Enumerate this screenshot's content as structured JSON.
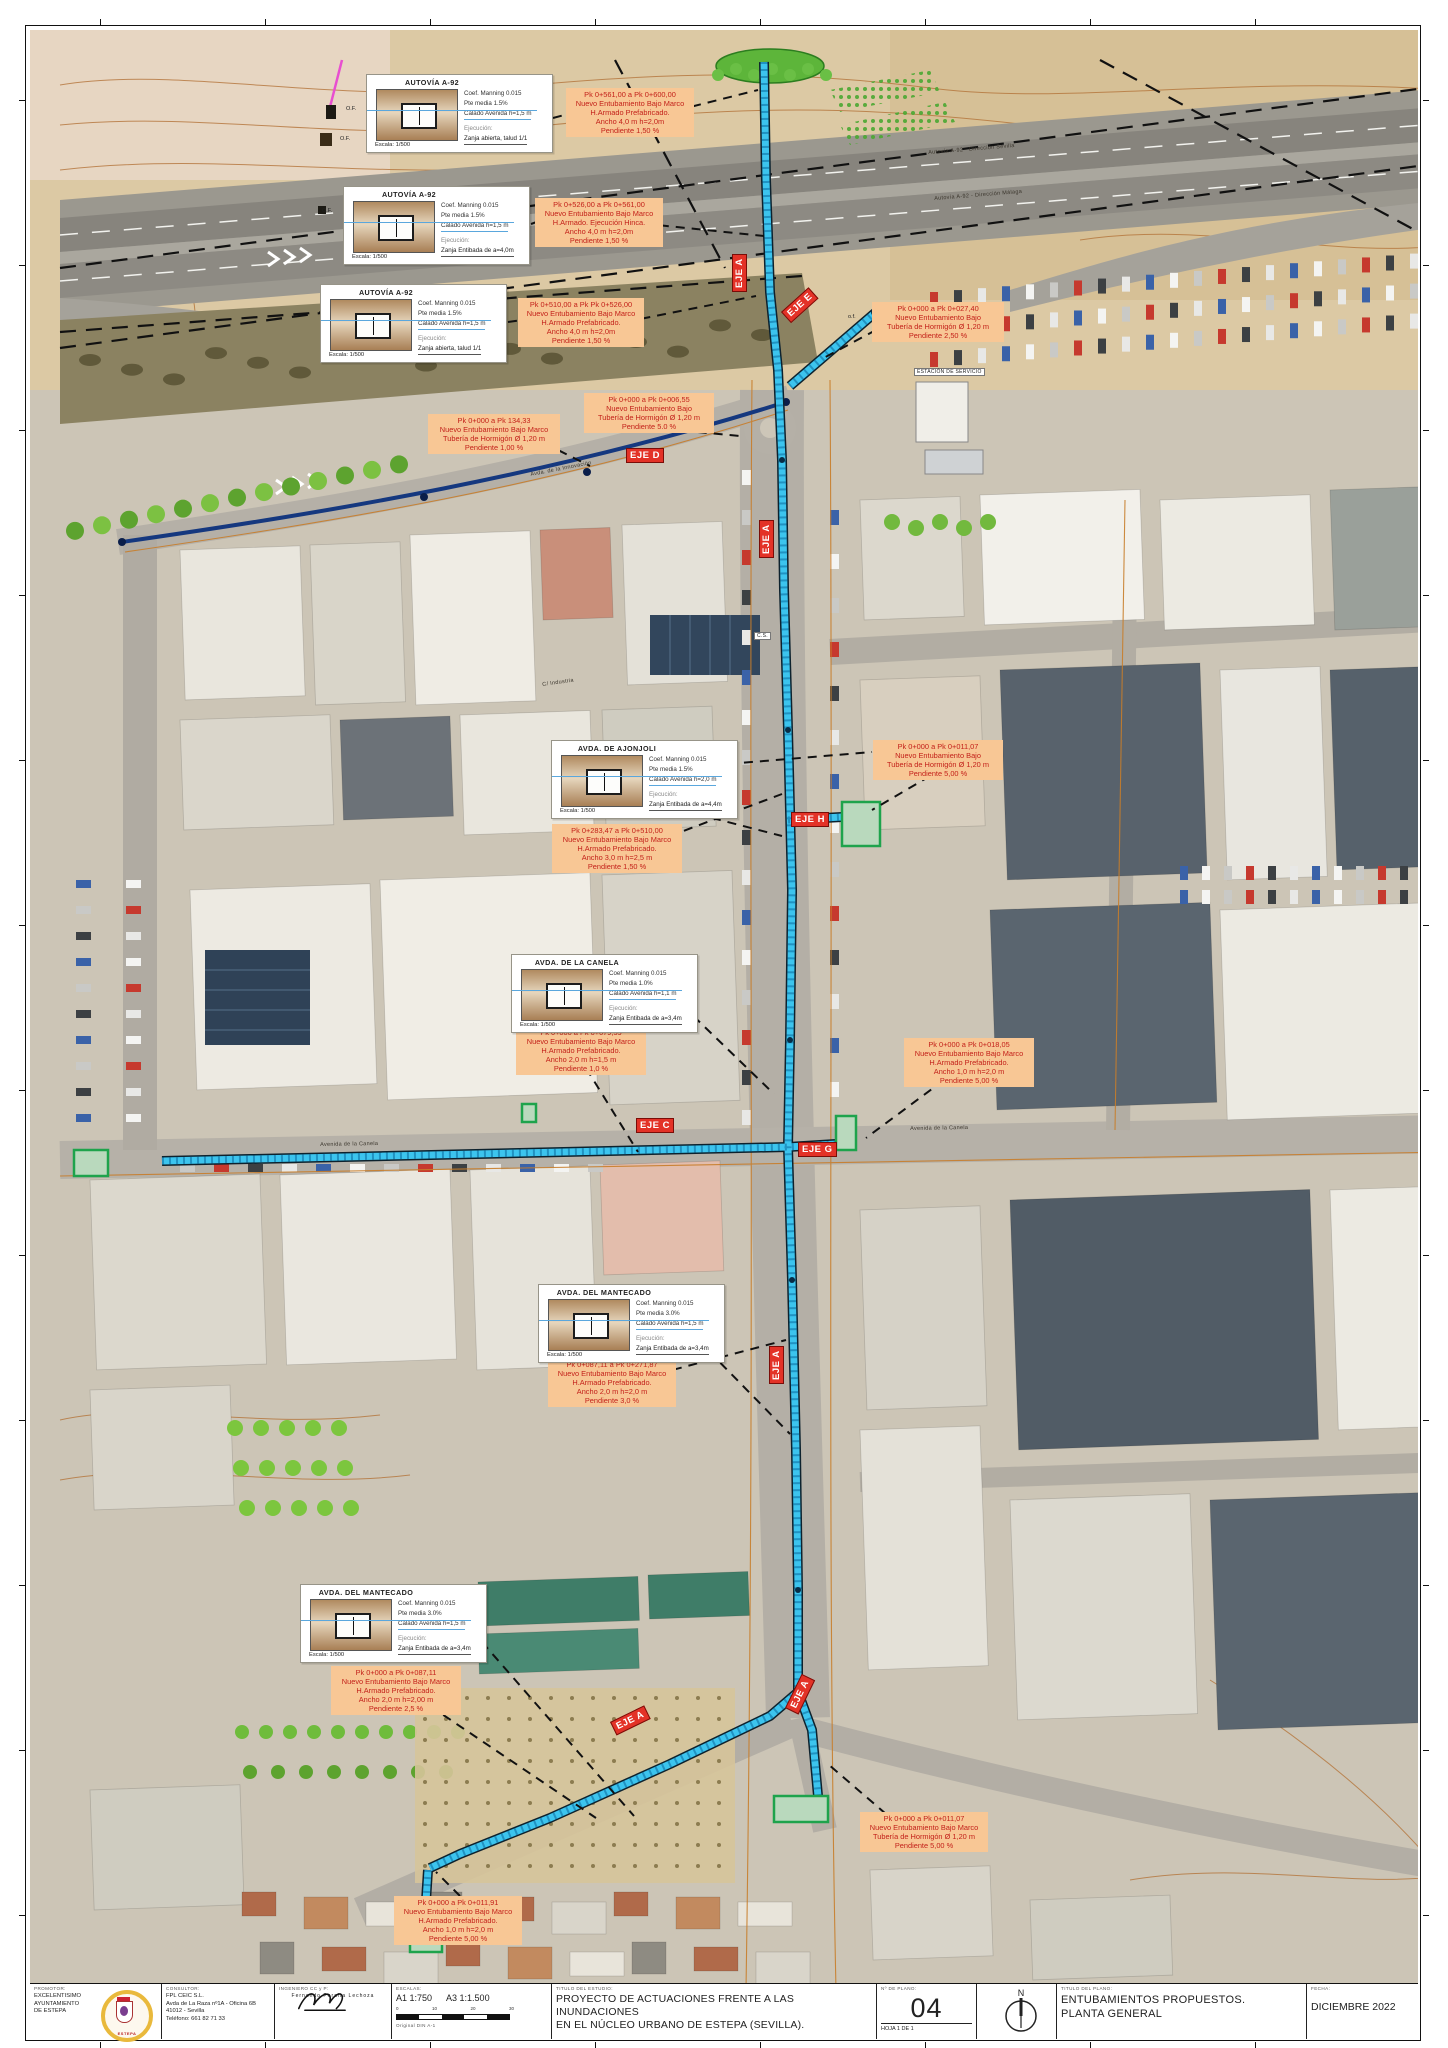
{
  "map": {
    "axis_labels": [
      {
        "label": "EJE A",
        "x": 702,
        "y": 262,
        "rot": -90
      },
      {
        "label": "EJE E",
        "x": 751,
        "y": 282,
        "rot": -42
      },
      {
        "label": "EJE D",
        "x": 596,
        "y": 418,
        "rot": 0
      },
      {
        "label": "EJE A",
        "x": 729,
        "y": 528,
        "rot": -90
      },
      {
        "label": "EJE H",
        "x": 761,
        "y": 782,
        "rot": 0
      },
      {
        "label": "EJE C",
        "x": 606,
        "y": 1088,
        "rot": 0
      },
      {
        "label": "EJE G",
        "x": 768,
        "y": 1112,
        "rot": 0
      },
      {
        "label": "EJE A",
        "x": 739,
        "y": 1354,
        "rot": -90
      },
      {
        "label": "EJE A",
        "x": 580,
        "y": 1692,
        "rot": -26
      },
      {
        "label": "EJE A",
        "x": 755,
        "y": 1678,
        "rot": -64
      }
    ],
    "detail_boxes": [
      {
        "x": 336,
        "y": 44,
        "title": "AUTOVÍA A-92",
        "coef": "Coef. Manning 0.015",
        "pte": "Pte media 1.5%",
        "calado": "Calado Avenida h=1,5 m",
        "ejec_label": "Ejecución:",
        "ejec": "Zanja abierta, talud 1/1",
        "escala": "Escala: 1/500"
      },
      {
        "x": 313,
        "y": 156,
        "title": "AUTOVÍA A-92",
        "coef": "Coef. Manning 0.015",
        "pte": "Pte media 1.5%",
        "calado": "Calado Avenida h=1,5 m",
        "ejec_label": "Ejecución:",
        "ejec": "Zanja Entibada de a=4,0m",
        "escala": "Escala: 1/500"
      },
      {
        "x": 290,
        "y": 254,
        "title": "AUTOVÍA A-92",
        "coef": "Coef. Manning 0.015",
        "pte": "Pte media 1.5%",
        "calado": "Calado Avenida h=1,5 m",
        "ejec_label": "Ejecución:",
        "ejec": "Zanja abierta, talud 1/1",
        "escala": "Escala: 1/500"
      },
      {
        "x": 521,
        "y": 710,
        "title": "AVDA. DE AJONJOLI",
        "coef": "Coef. Manning 0.015",
        "pte": "Pte media 1.5%",
        "calado": "Calado Avenida h=2,0 m",
        "ejec_label": "Ejecución:",
        "ejec": "Zanja Entibada de a=4,4m",
        "escala": "Escala: 1/500"
      },
      {
        "x": 481,
        "y": 924,
        "title": "AVDA. DE LA CANELA",
        "coef": "Coef. Manning 0.015",
        "pte": "Pte media 1.0%",
        "calado": "Calado Avenida h=1,1 m",
        "ejec_label": "Ejecución:",
        "ejec": "Zanja Entibada de a=3,4m",
        "escala": "Escala: 1/500"
      },
      {
        "x": 508,
        "y": 1254,
        "title": "AVDA. DEL MANTECADO",
        "coef": "Coef. Manning 0.015",
        "pte": "Pte media 3.0%",
        "calado": "Calado Avenida h=1,5 m",
        "ejec_label": "Ejecución:",
        "ejec": "Zanja Entibada de a=3,4m",
        "escala": "Escala: 1/500"
      },
      {
        "x": 270,
        "y": 1554,
        "title": "AVDA. DEL MANTECADO",
        "coef": "Coef. Manning 0.015",
        "pte": "Pte media 3.0%",
        "calado": "Calado Avenida h=1,5 m",
        "ejec_label": "Ejecución:",
        "ejec": "Zanja Entibada de a=3,4m",
        "escala": "Escala: 1/500"
      }
    ],
    "annotations": [
      {
        "x": 536,
        "y": 58,
        "w": 128,
        "lines": [
          "Pk 0+561,00 a Pk 0+600,00",
          "Nuevo Entubamiento Bajo Marco",
          "H.Armado Prefabricado.",
          "Ancho 4,0 m h=2,0m",
          "Pendiente 1,50 %"
        ]
      },
      {
        "x": 505,
        "y": 168,
        "w": 128,
        "lines": [
          "Pk 0+526,00 a Pk 0+561,00",
          "Nuevo Entubamiento Bajo Marco",
          "H.Armado. Ejecución Hinca.",
          "Ancho 4,0 m h=2,0m",
          "Pendiente 1,50 %"
        ]
      },
      {
        "x": 488,
        "y": 268,
        "w": 126,
        "lines": [
          "Pk 0+510,00 a Pk Pk 0+526,00",
          "Nuevo Entubamiento Bajo Marco",
          "H.Armado Prefabricado.",
          "Ancho 4,0 m h=2,0m",
          "Pendiente 1,50 %"
        ]
      },
      {
        "x": 842,
        "y": 272,
        "w": 132,
        "lines": [
          "Pk  0+000 a Pk 0+027,40",
          "Nuevo Entubamiento Bajo",
          "Tubería de  Hormigón Ø 1,20 m",
          "Pendiente 2,50 %"
        ]
      },
      {
        "x": 398,
        "y": 384,
        "w": 132,
        "lines": [
          "Pk  0+000 a Pk 134,33",
          "Nuevo Entubamiento Bajo Marco",
          "Tubería de  Hormigón Ø 1,20 m",
          "Pendiente 1,00 %"
        ]
      },
      {
        "x": 554,
        "y": 363,
        "w": 130,
        "lines": [
          "Pk  0+000 a Pk 0+006,55",
          "Nuevo Entubamiento Bajo",
          "Tubería de  Hormigón Ø 1,20 m",
          "Pendiente 5.0 %"
        ]
      },
      {
        "x": 843,
        "y": 710,
        "w": 130,
        "lines": [
          "Pk 0+000 a Pk 0+011,07",
          "Nuevo Entubamiento Bajo",
          "Tubería de  Hormigón Ø 1,20 m",
          "Pendiente 5,00 %"
        ]
      },
      {
        "x": 522,
        "y": 794,
        "w": 130,
        "lines": [
          "Pk 0+283,47 a Pk 0+510,00",
          "Nuevo Entubamiento Bajo Marco",
          "H.Armado Prefabricado.",
          "Ancho 3,0 m h=2,5 m",
          "Pendiente 1,50 %"
        ]
      },
      {
        "x": 486,
        "y": 996,
        "w": 130,
        "lines": [
          "Pk 0+000 a Pk 0+079,59",
          "Nuevo Entubamiento Bajo Marco",
          "H.Armado Prefabricado.",
          "Ancho 2,0 m h=1,5 m",
          "Pendiente 1,0 %"
        ]
      },
      {
        "x": 874,
        "y": 1008,
        "w": 130,
        "lines": [
          "Pk 0+000 a Pk 0+018,05",
          "Nuevo Entubamiento Bajo Marco",
          "H.Armado Prefabricado.",
          "Ancho 1,0 m h=2,0 m",
          "Pendiente 5,00 %"
        ]
      },
      {
        "x": 518,
        "y": 1328,
        "w": 128,
        "lines": [
          "Pk 0+087,11 a Pk 0+271,87",
          "Nuevo Entubamiento Bajo Marco",
          "H.Armado Prefabricado.",
          "Ancho 2,0 m h=2,0 m",
          "Pendiente 3,0 %"
        ]
      },
      {
        "x": 301,
        "y": 1636,
        "w": 130,
        "lines": [
          "Pk 0+000 a Pk 0+087,11",
          "Nuevo Entubamiento Bajo Marco",
          "H.Armado Prefabricado.",
          "Ancho 2,0 m h=2,00 m",
          "Pendiente 2,5 %"
        ]
      },
      {
        "x": 830,
        "y": 1782,
        "w": 128,
        "lines": [
          "Pk 0+000 a Pk 0+011,07",
          "Nuevo Entubamiento Bajo Marco",
          "Tubería de  Hormigón Ø 1,20 m",
          "Pendiente 5,00 %"
        ]
      },
      {
        "x": 364,
        "y": 1866,
        "w": 128,
        "lines": [
          "Pk 0+000 a Pk 0+011,91",
          "Nuevo Entubamiento Bajo Marco",
          "H.Armado Prefabricado.",
          "Ancho 1,0 m h=2,0 m",
          "Pendiente 5,00 %"
        ]
      }
    ],
    "street_labels": [
      {
        "text": "Autovía A-92 - Dirección Sevilla",
        "x": 898,
        "y": 120,
        "rot": -4.6,
        "boxed": false
      },
      {
        "text": "Autovía A-92 - Dirección Málaga",
        "x": 904,
        "y": 166,
        "rot": -4.6,
        "boxed": false
      },
      {
        "text": "Avda. de la Innovación",
        "x": 500,
        "y": 442,
        "rot": -11,
        "boxed": false
      },
      {
        "text": "C/ Industria",
        "x": 512,
        "y": 652,
        "rot": -8,
        "boxed": false
      },
      {
        "text": "Avenida de la Canela",
        "x": 290,
        "y": 1112,
        "rot": -1,
        "boxed": false
      },
      {
        "text": "Avenida de la Canela",
        "x": 880,
        "y": 1096,
        "rot": -1,
        "boxed": false
      },
      {
        "text": "ESTACIÓN DE SERVICIO",
        "x": 884,
        "y": 338,
        "rot": 0,
        "boxed": true
      },
      {
        "text": "C.S.",
        "x": 724,
        "y": 602,
        "rot": 0,
        "boxed": true
      }
    ],
    "of_labels": [
      {
        "text": "O.F.",
        "x": 316,
        "y": 76
      },
      {
        "text": "O.F.",
        "x": 310,
        "y": 106
      },
      {
        "text": "O.F.",
        "x": 292,
        "y": 178
      },
      {
        "text": "o.f.",
        "x": 818,
        "y": 284
      }
    ]
  },
  "titleblock": {
    "promotor_label": "PROMOTOR:",
    "promotor_lines": [
      "EXCELENTISIMO",
      "AYUNTAMIENTO",
      "DE ESTEPA"
    ],
    "logo_text": "ESTEPA",
    "consultor_label": "CONSULTOR:",
    "consultor_lines": [
      "FPL CEIC S.L.",
      "Avda de La Raza nº1A - Oficina 6B",
      "41012 - Sevilla",
      "Teléfono: 661 82 71 33"
    ],
    "ingeniero_label": "INGENIERO CC y P:",
    "ingeniero": "Fernando Peralta Lechoza",
    "escalas_label": "ESCALAS:",
    "escala_a1": "A1  1:750",
    "escala_a3": "A3  1:1.500",
    "scalebar_ticks": [
      "0",
      "10",
      "20",
      "30"
    ],
    "original": "Original DIN A-1",
    "titulo_estudio_label": "TITULO DEL ESTUDIO:",
    "titulo_estudio_lines": [
      "PROYECTO DE ACTUACIONES FRENTE A LAS INUNDACIONES",
      "EN EL NÚCLEO URBANO DE ESTEPA (SEVILLA)."
    ],
    "num_plano_label": "Nº DE PLANO:",
    "num_plano": "04",
    "hoja": "HOJA 1 DE 1",
    "north_label": "N",
    "titulo_plano_label": "TITULO DEL PLANO:",
    "titulo_plano_lines": [
      "ENTUBAMIENTOS PROPUESTOS.",
      "PLANTA GENERAL"
    ],
    "fecha_label": "FECHA:",
    "fecha": "DICIEMBRE 2022"
  },
  "colors": {
    "pipe_cyan": "#3cc4ee",
    "pipe_hatch": "#0a6a9e",
    "eje_red": "#e33227",
    "callout_bg": "#f8c795",
    "callout_text": "#c3211a",
    "structure_green": "#1ea34c",
    "eje_d_navy": "#15387f"
  }
}
